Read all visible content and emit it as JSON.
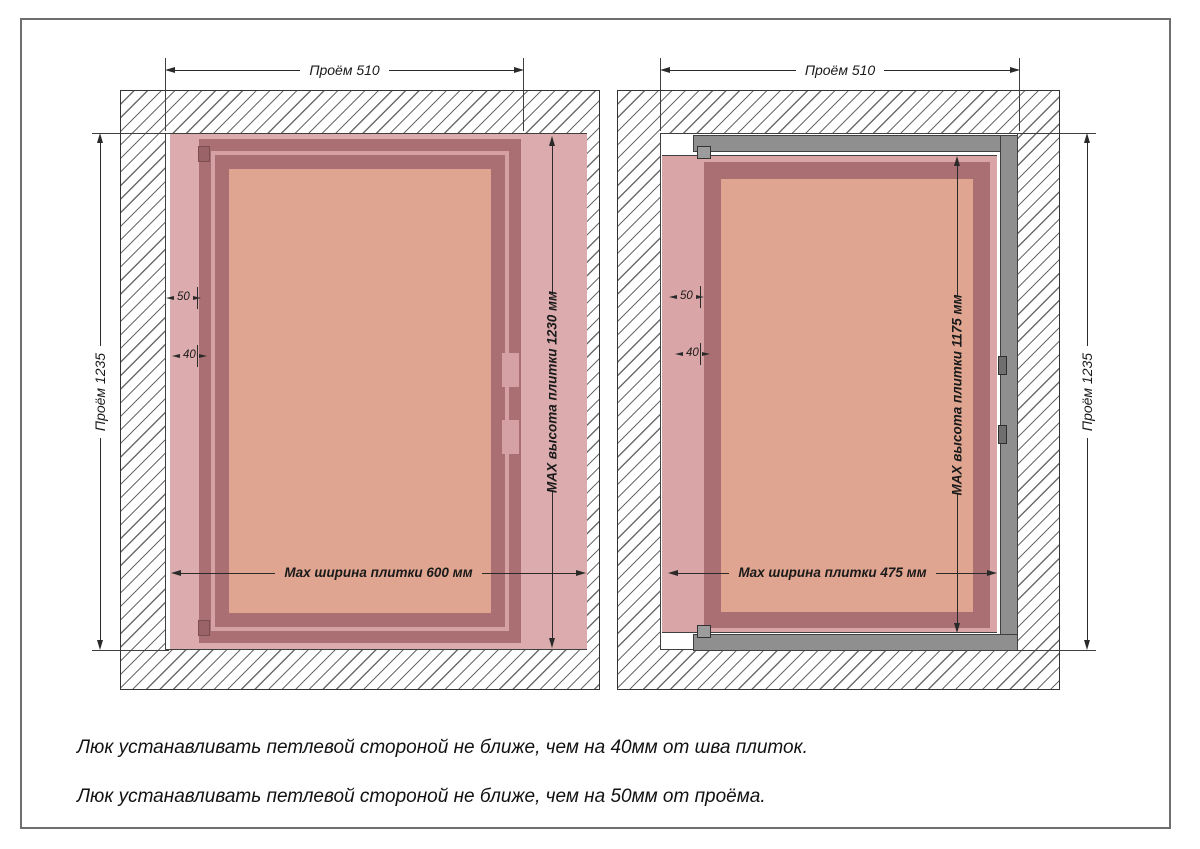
{
  "colors": {
    "tile": "#dcabad",
    "tile2": "#d9a5a6",
    "frame_dark": "#a96f72",
    "strip_light": "#d5a1a4",
    "panel": "#dfa590",
    "metal": "#8f8f8f",
    "line": "#2a2a2a"
  },
  "left": {
    "dim_top": "Проём 510",
    "dim_side": "Проём 1235",
    "dim_max_height": "MAX высота плитки 1230 мм",
    "dim_max_width": "Max ширина плитки 600 мм",
    "dim_offset_opening": "50",
    "dim_offset_seam": "40"
  },
  "right": {
    "dim_top": "Проём 510",
    "dim_side": "Проём 1235",
    "dim_max_height": "MAX высота плитки 1175 мм",
    "dim_max_width": "Max ширина плитки 475 мм",
    "dim_offset_opening": "50",
    "dim_offset_seam": "40"
  },
  "notes": {
    "line1": "Люк устанавливать петлевой стороной не ближе, чем на 40мм от шва плиток.",
    "line2": "Люк устанавливать петлевой стороной не ближе, чем на 50мм от проёма."
  }
}
